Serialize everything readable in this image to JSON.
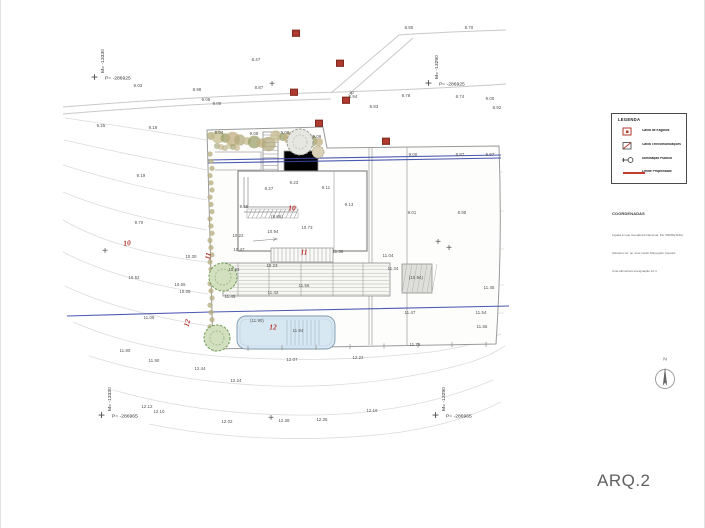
{
  "sheet": {
    "code": "ARQ.2"
  },
  "north_label": "N",
  "colors": {
    "accent_red": "#b5342c",
    "utility_blue_line": "#3848a8",
    "pool_fill": "#d8e8f2",
    "contour_gray": "#dcdcdc",
    "vegetation_olive": "#b3a97c",
    "tree_green": "#6f9a53"
  },
  "legend": {
    "header": "LEGENDA",
    "items": [
      {
        "icon": "sewage-box-icon",
        "label": "Caixa de Esgotos"
      },
      {
        "icon": "telecom-box-icon",
        "label": "Caixa Telecomunicações"
      },
      {
        "icon": "street-light-icon",
        "label": "Iluminação Pública"
      },
      {
        "icon": "property-limit-line",
        "label": "Limite Propriedade"
      }
    ]
  },
  "notes": {
    "header": "COORDENADAS",
    "lines": [
      "Ligada à rede Geodésica Nacional, Pto INDIRETADA",
      "(Moledo) ref. ao nível médio Marégrafo Cascais",
      "Cota altimétrica triangulação 10.4"
    ]
  },
  "corner_markers": {
    "top_left": {
      "m": "M= -13330",
      "p": "P= -286925"
    },
    "top_right": {
      "m": "M= -13290",
      "p": "P= -286925"
    },
    "bottom_left": {
      "m": "M= -13330",
      "p": "P= -286965"
    },
    "bottom_right": {
      "m": "M= -13290",
      "p": "P= -286965"
    }
  },
  "plan": {
    "spot_elevations": [
      {
        "v": "8.80",
        "x": 408,
        "y": 28
      },
      {
        "v": "8.70",
        "x": 468,
        "y": 28
      },
      {
        "v": "8.47",
        "x": 255,
        "y": 60
      },
      {
        "v": "9.03",
        "x": 137,
        "y": 86
      },
      {
        "v": "8.98",
        "x": 196,
        "y": 90
      },
      {
        "v": "8.87",
        "x": 258,
        "y": 88
      },
      {
        "v": "9.05",
        "x": 205,
        "y": 100
      },
      {
        "v": "9.00",
        "x": 216,
        "y": 104
      },
      {
        "v": "8.94",
        "x": 352,
        "y": 97
      },
      {
        "v": "8.78",
        "x": 405,
        "y": 96
      },
      {
        "v": "8.83",
        "x": 373,
        "y": 107
      },
      {
        "v": "8.74",
        "x": 459,
        "y": 97
      },
      {
        "v": "9.00",
        "x": 489,
        "y": 99
      },
      {
        "v": "8.92",
        "x": 496,
        "y": 108
      },
      {
        "v": "9.25",
        "x": 100,
        "y": 126
      },
      {
        "v": "9.18",
        "x": 152,
        "y": 128
      },
      {
        "v": "9.04",
        "x": 218,
        "y": 133
      },
      {
        "v": "9.08",
        "x": 253,
        "y": 134
      },
      {
        "v": "9.00",
        "x": 284,
        "y": 133
      },
      {
        "v": "9.06",
        "x": 316,
        "y": 137
      },
      {
        "v": "9.19",
        "x": 140,
        "y": 176
      },
      {
        "v": "9.00",
        "x": 412,
        "y": 155
      },
      {
        "v": "8.87",
        "x": 459,
        "y": 155
      },
      {
        "v": "8.97",
        "x": 489,
        "y": 155
      },
      {
        "v": "9.01",
        "x": 411,
        "y": 213
      },
      {
        "v": "8.95",
        "x": 461,
        "y": 213
      },
      {
        "v": "8.27",
        "x": 268,
        "y": 189
      },
      {
        "v": "9.23",
        "x": 293,
        "y": 183
      },
      {
        "v": "9.11",
        "x": 325,
        "y": 188
      },
      {
        "v": "9.13",
        "x": 348,
        "y": 205
      },
      {
        "v": "9.55",
        "x": 243,
        "y": 207
      },
      {
        "v": "(9.86)",
        "x": 276,
        "y": 217
      },
      {
        "v": "10.94",
        "x": 272,
        "y": 232
      },
      {
        "v": "10.73",
        "x": 306,
        "y": 228
      },
      {
        "v": "10.22",
        "x": 237,
        "y": 236
      },
      {
        "v": "10.47",
        "x": 238,
        "y": 250
      },
      {
        "v": "11.38",
        "x": 337,
        "y": 252
      },
      {
        "v": "9.70",
        "x": 138,
        "y": 223
      },
      {
        "v": "10.30",
        "x": 190,
        "y": 257
      },
      {
        "v": "10.52",
        "x": 133,
        "y": 278
      },
      {
        "v": "10.55",
        "x": 179,
        "y": 285
      },
      {
        "v": "10.08",
        "x": 184,
        "y": 292
      },
      {
        "v": "11.09",
        "x": 148,
        "y": 318
      },
      {
        "v": "11.04",
        "x": 387,
        "y": 256
      },
      {
        "v": "11.34",
        "x": 392,
        "y": 269
      },
      {
        "v": "10.82",
        "x": 233,
        "y": 270
      },
      {
        "v": "10.23",
        "x": 271,
        "y": 266
      },
      {
        "v": "11.56",
        "x": 303,
        "y": 286
      },
      {
        "v": "11.42",
        "x": 272,
        "y": 293
      },
      {
        "v": "11.45",
        "x": 229,
        "y": 297
      },
      {
        "v": "(10.94)",
        "x": 415,
        "y": 278
      },
      {
        "v": "11.45",
        "x": 488,
        "y": 288
      },
      {
        "v": "11.47",
        "x": 409,
        "y": 313
      },
      {
        "v": "11.54",
        "x": 480,
        "y": 313
      },
      {
        "v": "11.56",
        "x": 481,
        "y": 327
      },
      {
        "v": "(11.90)",
        "x": 256,
        "y": 321
      },
      {
        "v": "11.94",
        "x": 297,
        "y": 331
      },
      {
        "v": "11.80",
        "x": 124,
        "y": 351
      },
      {
        "v": "11.90",
        "x": 153,
        "y": 361
      },
      {
        "v": "11.76",
        "x": 414,
        "y": 345
      },
      {
        "v": "12.07",
        "x": 291,
        "y": 360
      },
      {
        "v": "12.22",
        "x": 357,
        "y": 358
      },
      {
        "v": "12.44",
        "x": 199,
        "y": 369
      },
      {
        "v": "12.24",
        "x": 235,
        "y": 381
      },
      {
        "v": "12.02",
        "x": 226,
        "y": 422
      },
      {
        "v": "12.38",
        "x": 283,
        "y": 421
      },
      {
        "v": "12.35",
        "x": 321,
        "y": 420
      },
      {
        "v": "12.16",
        "x": 371,
        "y": 411
      },
      {
        "v": "12.12",
        "x": 146,
        "y": 407
      },
      {
        "v": "12.10",
        "x": 158,
        "y": 412
      }
    ],
    "contour_labels": [
      {
        "t": "10",
        "x": 126,
        "y": 243,
        "rot": -8
      },
      {
        "t": "12",
        "x": 186,
        "y": 323,
        "rot": -75
      },
      {
        "t": "11",
        "x": 207,
        "y": 256,
        "rot": -80
      },
      {
        "t": "10",
        "x": 291,
        "y": 208,
        "rot": 0
      },
      {
        "t": "11",
        "x": 303,
        "y": 252,
        "rot": 0
      },
      {
        "t": "12",
        "x": 272,
        "y": 327,
        "rot": 0
      }
    ],
    "utility_boxes": [
      {
        "x": 295,
        "y": 33
      },
      {
        "x": 339,
        "y": 63
      },
      {
        "x": 293,
        "y": 92
      },
      {
        "x": 345,
        "y": 100
      },
      {
        "x": 318,
        "y": 123
      },
      {
        "x": 385,
        "y": 141
      }
    ],
    "crosses": [
      {
        "x": 271,
        "y": 85
      },
      {
        "x": 104,
        "y": 252
      },
      {
        "x": 437,
        "y": 243
      },
      {
        "x": 448,
        "y": 249
      },
      {
        "x": 270,
        "y": 419
      }
    ],
    "misc_labels": [
      {
        "t": "ip",
        "x": 351,
        "y": 93
      }
    ]
  }
}
